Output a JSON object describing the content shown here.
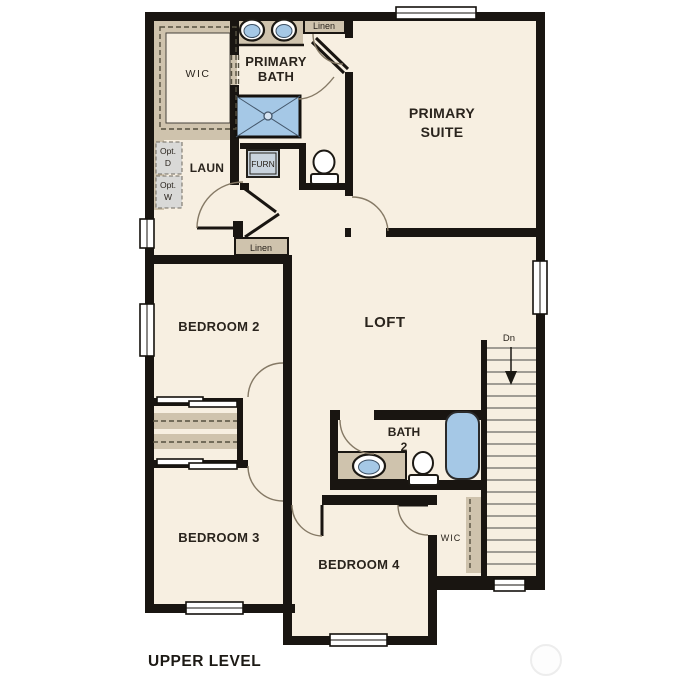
{
  "colors": {
    "wall": "#191511",
    "floor": "#f7efe1",
    "cabinet_tan": "#cfc3ad",
    "fixture_blue": "#a5c8e6",
    "optional_gray": "#d9d9d7",
    "furnace_fill": "#c9d3dd",
    "door_arc": "#857965",
    "text": "#2a241d"
  },
  "labels": {
    "wic_primary": [
      "WIC"
    ],
    "primary_bath": [
      "PRIMARY",
      "BATH"
    ],
    "linen_upper": [
      "Linen"
    ],
    "primary_suite": [
      "PRIMARY",
      "SUITE"
    ],
    "opt_dryer": [
      "Opt.",
      "D"
    ],
    "opt_washer": [
      "Opt.",
      "W"
    ],
    "laundry": [
      "LAUN"
    ],
    "furnace": [
      "FURN"
    ],
    "linen_hall": [
      "Linen"
    ],
    "bedroom2": [
      "BEDROOM 2"
    ],
    "loft": [
      "LOFT"
    ],
    "stair_direction": [
      "Dn"
    ],
    "bath2": [
      "BATH",
      "2"
    ],
    "bedroom3": [
      "BEDROOM 3"
    ],
    "bedroom4": [
      "BEDROOM 4"
    ],
    "wic_bedroom4": [
      "WIC"
    ],
    "level_title": [
      "UPPER LEVEL"
    ]
  }
}
